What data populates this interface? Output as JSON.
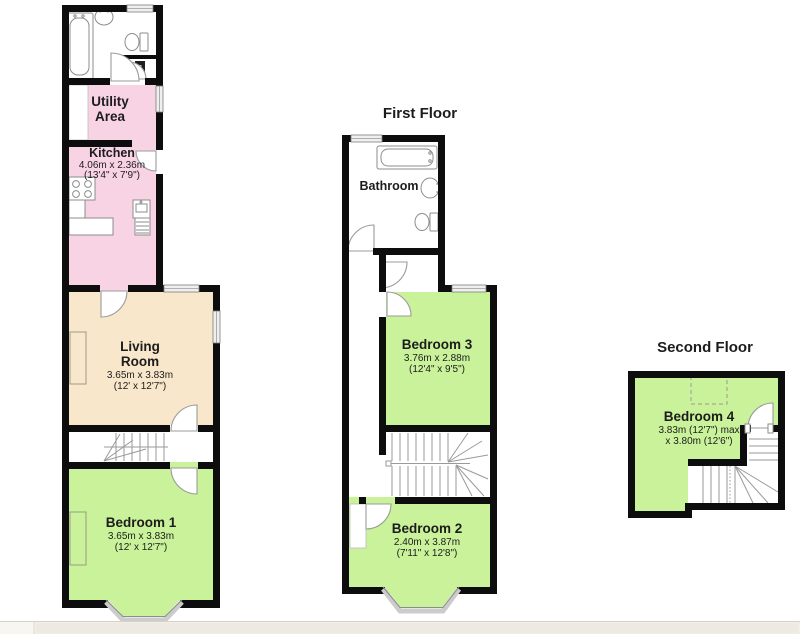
{
  "colors": {
    "wall": "#0d0d0d",
    "room_green": "#c9f29b",
    "room_pink": "#f8d3e3",
    "room_beige": "#f8e7cb",
    "door": "#9b9b9b",
    "fixture": "#8c8c8c",
    "window": "#efefef",
    "text": "#1c1c1c",
    "strip": "#f1eee7",
    "strip_edge": "#d6d2c7"
  },
  "floors": {
    "ground": {
      "rooms": {
        "bathroom": {
          "boiler_label": "B"
        },
        "utility": {
          "name_line1": "Utility",
          "name_line2": "Area"
        },
        "kitchen": {
          "name": "Kitchen",
          "dims_metric": "4.06m x 2.36m",
          "dims_imperial": "(13'4\" x 7'9\")"
        },
        "living": {
          "name_line1": "Living",
          "name_line2": "Room",
          "dims_metric": "3.65m x 3.83m",
          "dims_imperial": "(12' x 12'7\")"
        },
        "bedroom1": {
          "name": "Bedroom 1",
          "dims_metric": "3.65m x 3.83m",
          "dims_imperial": "(12' x 12'7\")"
        }
      }
    },
    "first": {
      "title": "First Floor",
      "rooms": {
        "bathroom": {
          "name": "Bathroom"
        },
        "bedroom3": {
          "name": "Bedroom 3",
          "dims_metric": "3.76m x 2.88m",
          "dims_imperial": "(12'4\" x 9'5\")"
        },
        "bedroom2": {
          "name": "Bedroom 2",
          "dims_metric": "2.40m x 3.87m",
          "dims_imperial": "(7'11\" x 12'8\")"
        }
      }
    },
    "second": {
      "title": "Second Floor",
      "rooms": {
        "bedroom4": {
          "name": "Bedroom 4",
          "dims_line1": "3.83m (12'7\") max",
          "dims_line2": "x 3.80m (12'6\")"
        }
      }
    }
  }
}
